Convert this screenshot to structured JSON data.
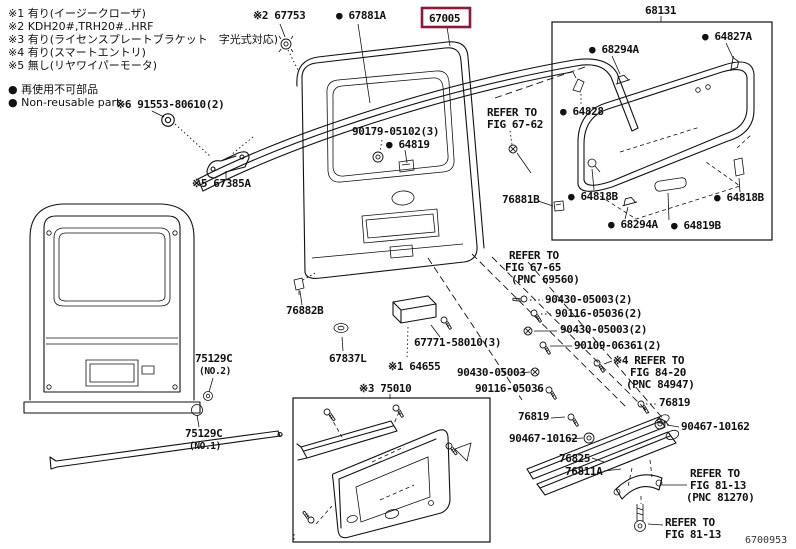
{
  "figure_code": "6700953",
  "colors": {
    "background": "#ffffff",
    "line": "#111111",
    "highlight_box": "#8b1a3a"
  },
  "legend": {
    "notes": [
      "※1 有り(イージークローザ)",
      "※2 KDH20#,TRH20#..HRF",
      "※3 有り(ライセンスプレートブラケット　字光式対応)",
      "※4 有り(スマートエントリ)",
      "※5 無し(リヤワイパーモータ)"
    ],
    "nonreusable_jp": "● 再使用不可部品",
    "nonreusable_en": "● Non-reusable part"
  },
  "parts": {
    "p67753": "※2 67753",
    "p67881A": "● 67881A",
    "p67005": "67005",
    "p68131": "68131",
    "p68294A": "● 68294A",
    "p64827A": "● 64827A",
    "p64828": "● 64828",
    "p64818B": "● 64818B",
    "p64819B": "● 64819B",
    "p90179": "90179-05102(3)",
    "p64819": "● 64819",
    "p91553": "※6 91553-80610(2)",
    "p67385A": "※5 67385A",
    "p76881B": "76881B",
    "p76882B": "76882B",
    "p67837L": "67837L",
    "p67771": "67771-58010(3)",
    "p64655": "※1 64655",
    "p75129C": "75129C",
    "no2": "(NO.2)",
    "no1": "(NO.1)",
    "p75010": "※3 75010",
    "p90430_2": "90430-05003(2)",
    "p90116_2": "90116-05036(2)",
    "p90109": "90109-06361(2)",
    "p90430": "90430-05003",
    "p90116": "90116-05036",
    "p76819": "76819",
    "p90467": "90467-10162",
    "p76825": "76825",
    "p76811A": "76811A"
  },
  "refers": {
    "fig6762": [
      "REFER TO",
      "FIG 67-62"
    ],
    "fig6765": [
      "REFER TO",
      "FIG 67-65",
      "(PNC 69560)"
    ],
    "fig8420": [
      "※4 REFER TO",
      "FIG 84-20",
      "(PNC 84947)"
    ],
    "fig8113pnc": [
      "REFER TO",
      "FIG 81-13",
      "(PNC 81270)"
    ],
    "fig8113": [
      "REFER TO",
      "FIG 81-13"
    ]
  }
}
